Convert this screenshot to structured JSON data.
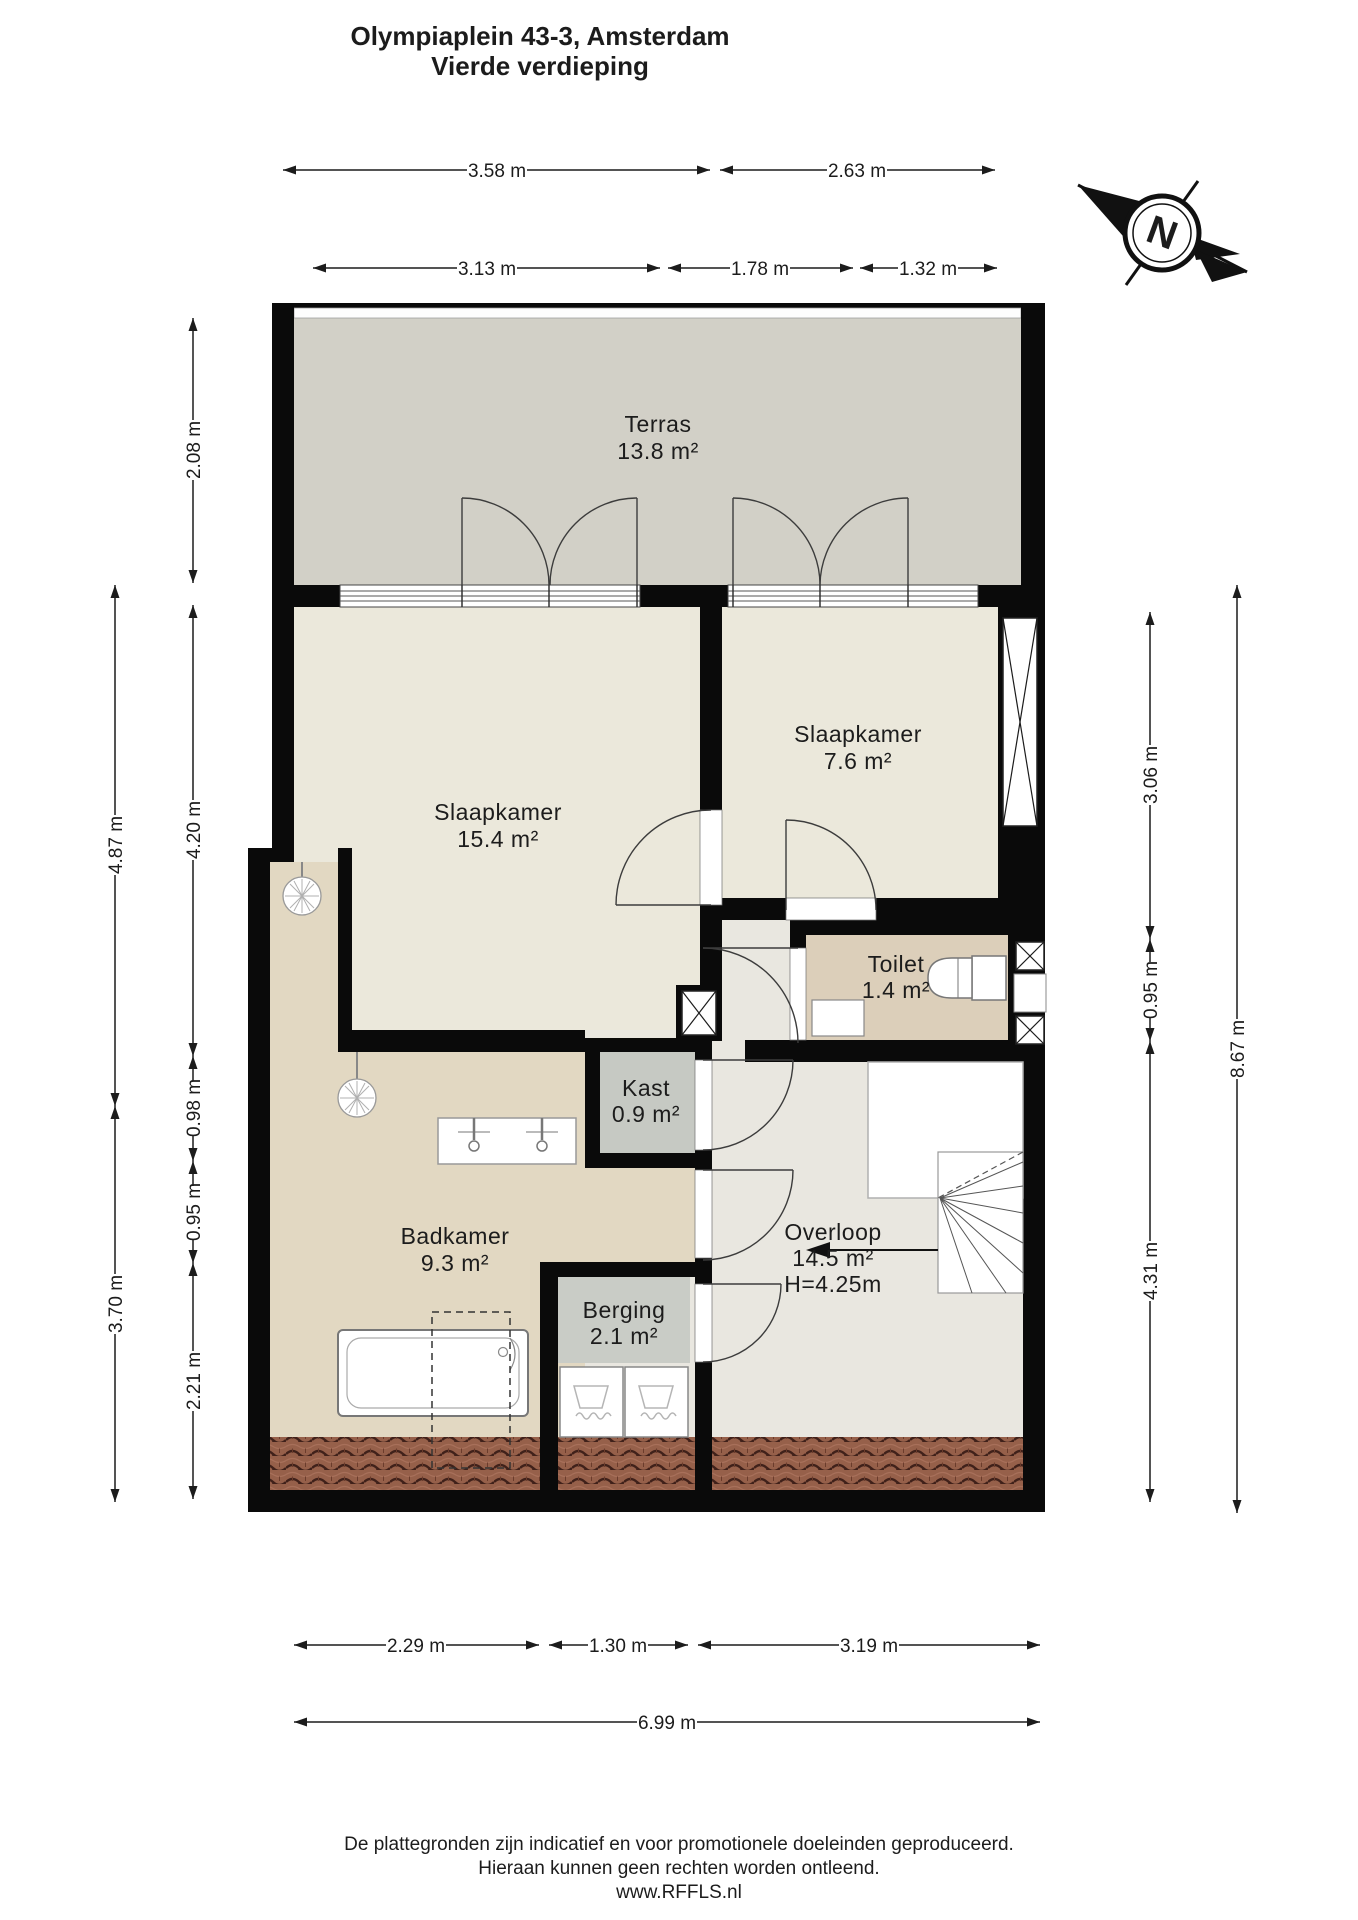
{
  "title": {
    "line1": "Olympiaplein 43-3, Amsterdam",
    "line2": "Vierde verdieping"
  },
  "compass": {
    "north_label": "N"
  },
  "rooms": {
    "terras": {
      "name": "Terras",
      "area": "13.8 m²"
    },
    "slaapkamer_groot": {
      "name": "Slaapkamer",
      "area": "15.4 m²"
    },
    "slaapkamer_klein": {
      "name": "Slaapkamer",
      "area": "7.6 m²"
    },
    "toilet": {
      "name": "Toilet",
      "area": "1.4 m²"
    },
    "kast": {
      "name": "Kast",
      "area": "0.9 m²"
    },
    "badkamer": {
      "name": "Badkamer",
      "area": "9.3 m²"
    },
    "berging": {
      "name": "Berging",
      "area": "2.1 m²"
    },
    "overloop": {
      "name": "Overloop",
      "area": "14.5 m²",
      "ceiling_height": "H=4.25m"
    }
  },
  "dimensions": {
    "top_row_1": [
      "3.58 m",
      "2.63 m"
    ],
    "top_row_2": [
      "3.13 m",
      "1.78 m",
      "1.32 m"
    ],
    "left_outer": [
      "4.87 m",
      "3.70 m"
    ],
    "left_inner": [
      "2.08 m",
      "4.20 m",
      "0.98 m",
      "0.95 m",
      "2.21 m"
    ],
    "right_inner": [
      "3.06 m",
      "0.95 m",
      "4.31 m"
    ],
    "right_outer": [
      "8.67 m"
    ],
    "bottom_row_1": [
      "2.29 m",
      "1.30 m",
      "3.19 m"
    ],
    "bottom_row_2": [
      "6.99 m"
    ]
  },
  "colors": {
    "wall": "#0a0a0a",
    "terrace_floor": "#d2d0c7",
    "bedroom_floor": "#ebe8db",
    "hall_floor": "#e9e7e0",
    "bathroom_floor": "#e2d8c2",
    "toilet_floor": "#dccfba",
    "closet_floor": "#c6c9c3",
    "storage_floor": "#c9ccc6",
    "roof_tile": "#96604a"
  },
  "footer": {
    "line1": "De plattegronden zijn indicatief en voor promotionele doeleinden geproduceerd.",
    "line2": "Hieraan kunnen geen rechten worden ontleend.",
    "line3": "www.RFFLS.nl"
  }
}
